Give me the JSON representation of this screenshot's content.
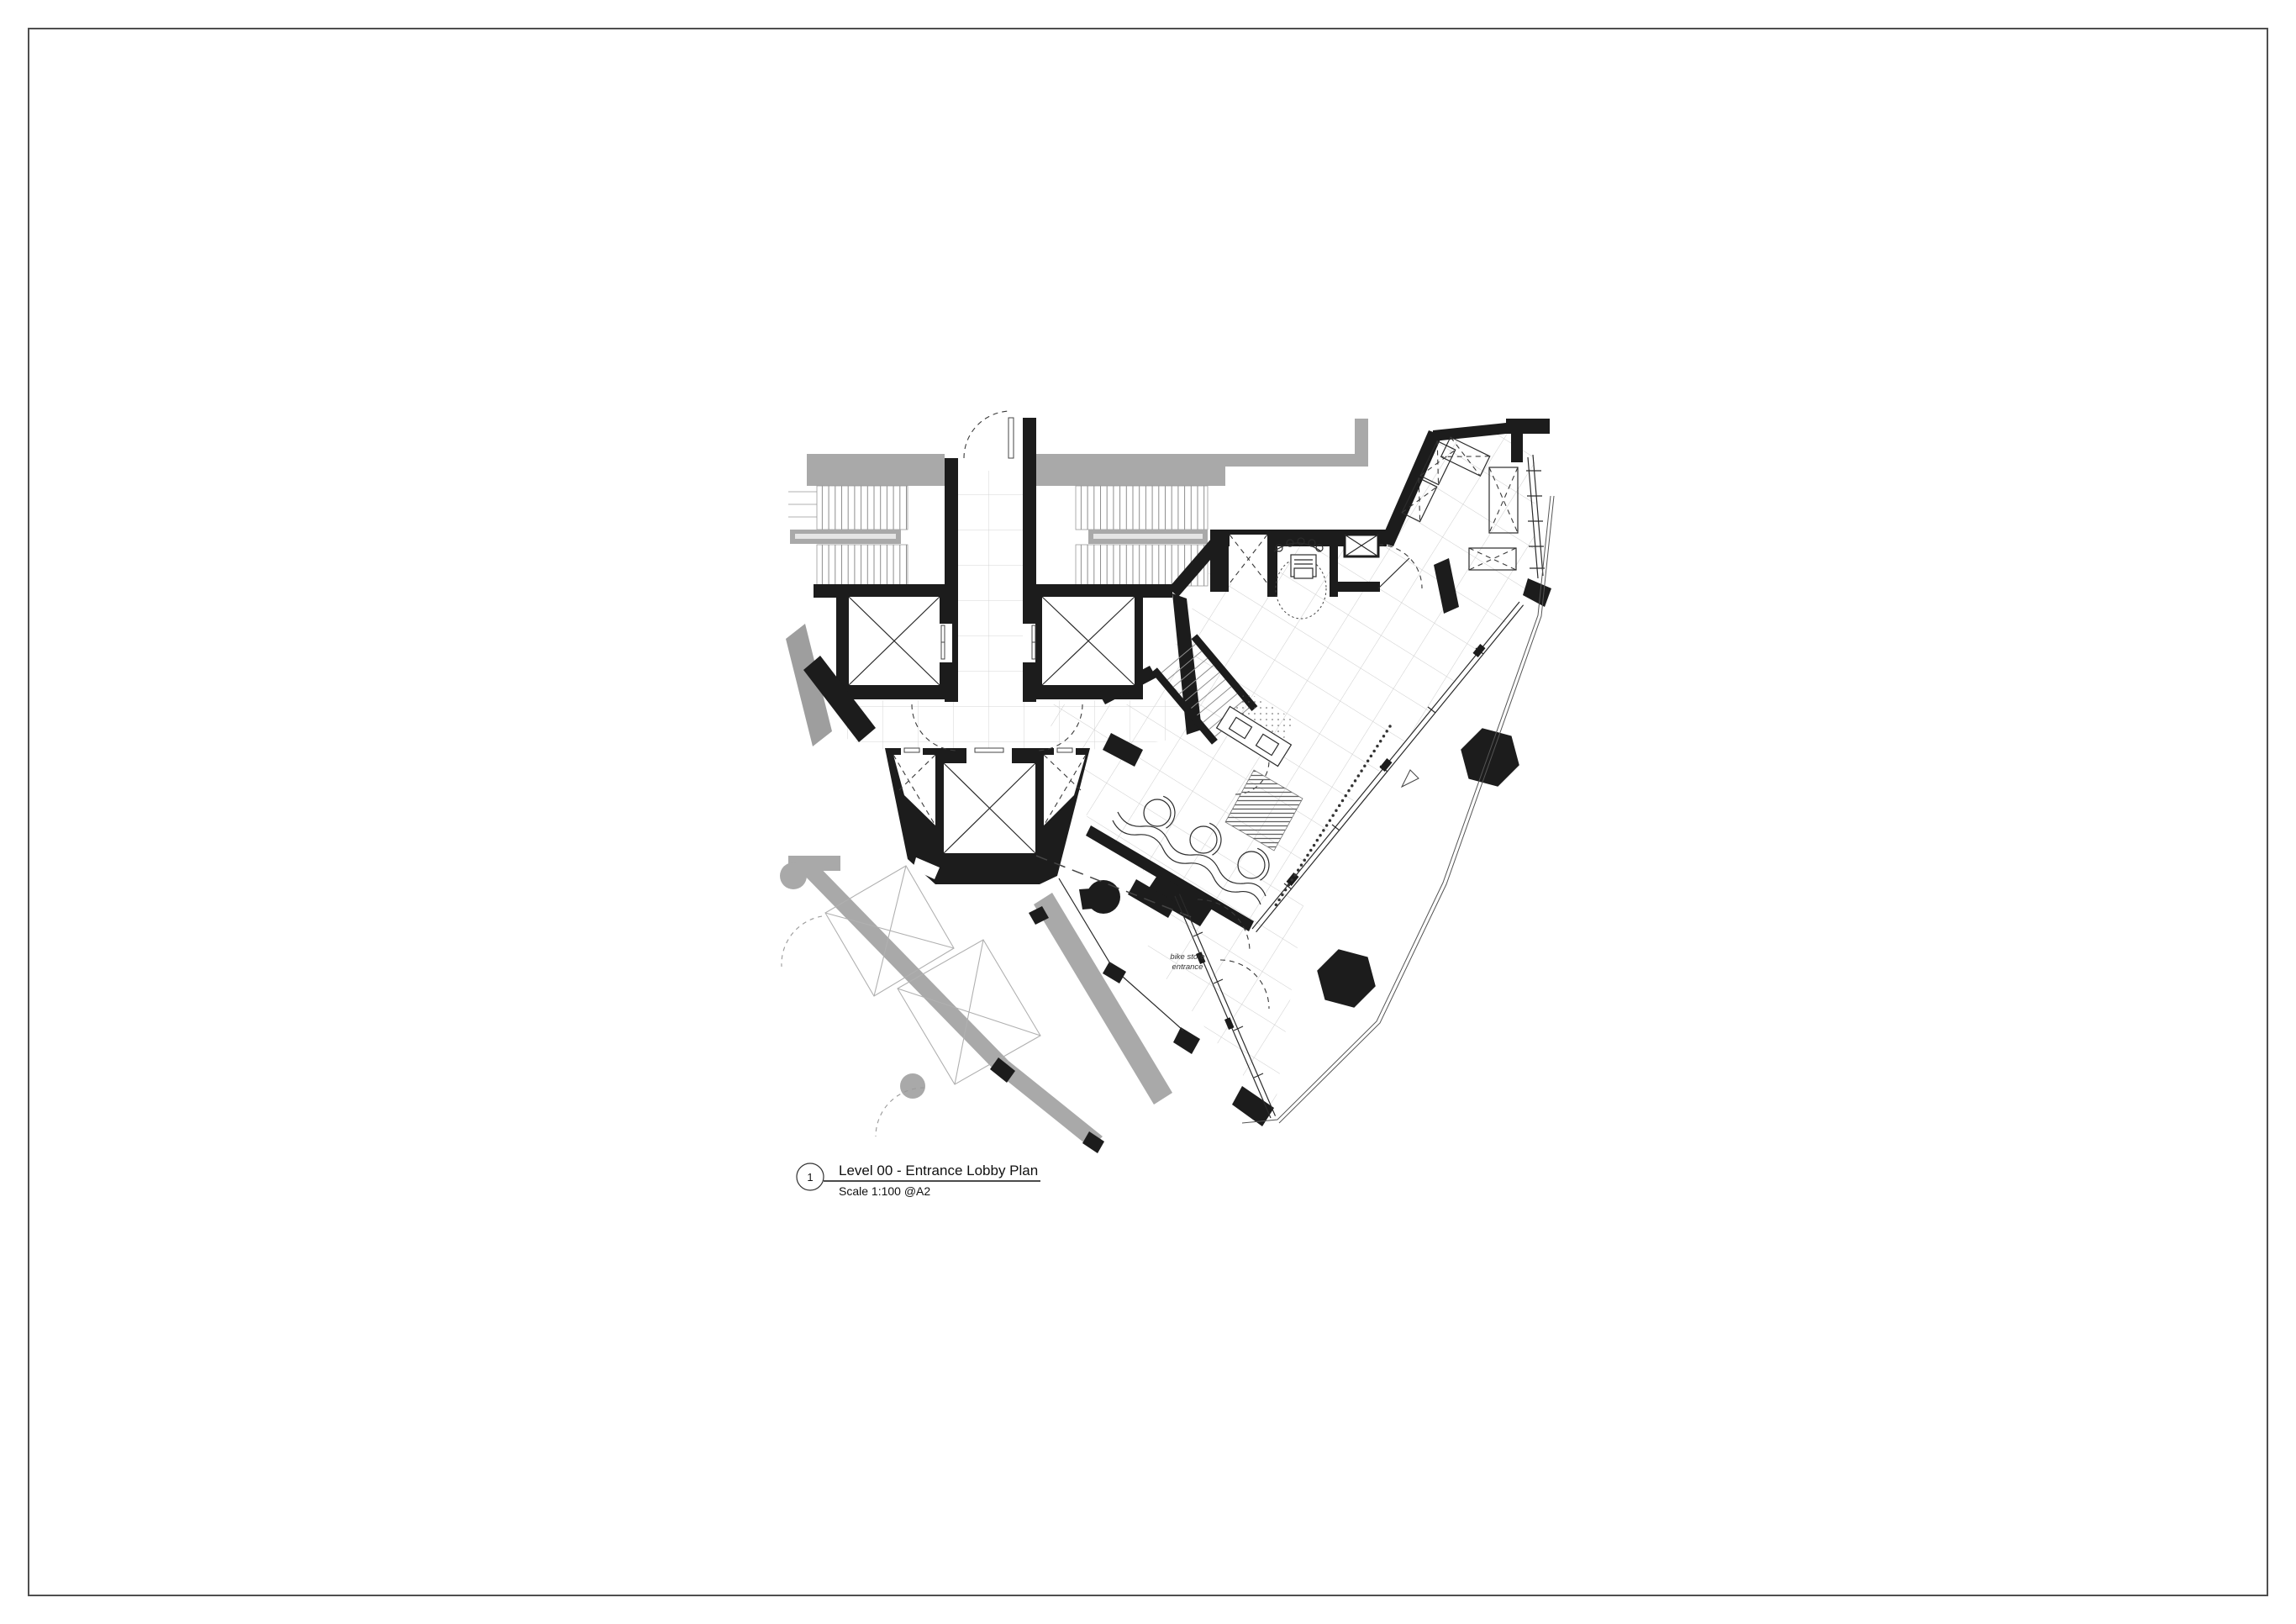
{
  "sheet": {
    "background": "#ffffff",
    "border_color": "#4f4f4f"
  },
  "title_block": {
    "detail_number": "1",
    "title": "Level 00 - Entrance Lobby Plan",
    "scale": "Scale 1:100 @A2"
  },
  "plan_labels": {
    "bike_store_line1": "bike store",
    "bike_store_line2": "entrance"
  },
  "colors": {
    "ink": "#1c1c1c",
    "context_gray": "#a9a9a9",
    "grid": "#d0d0d0"
  }
}
